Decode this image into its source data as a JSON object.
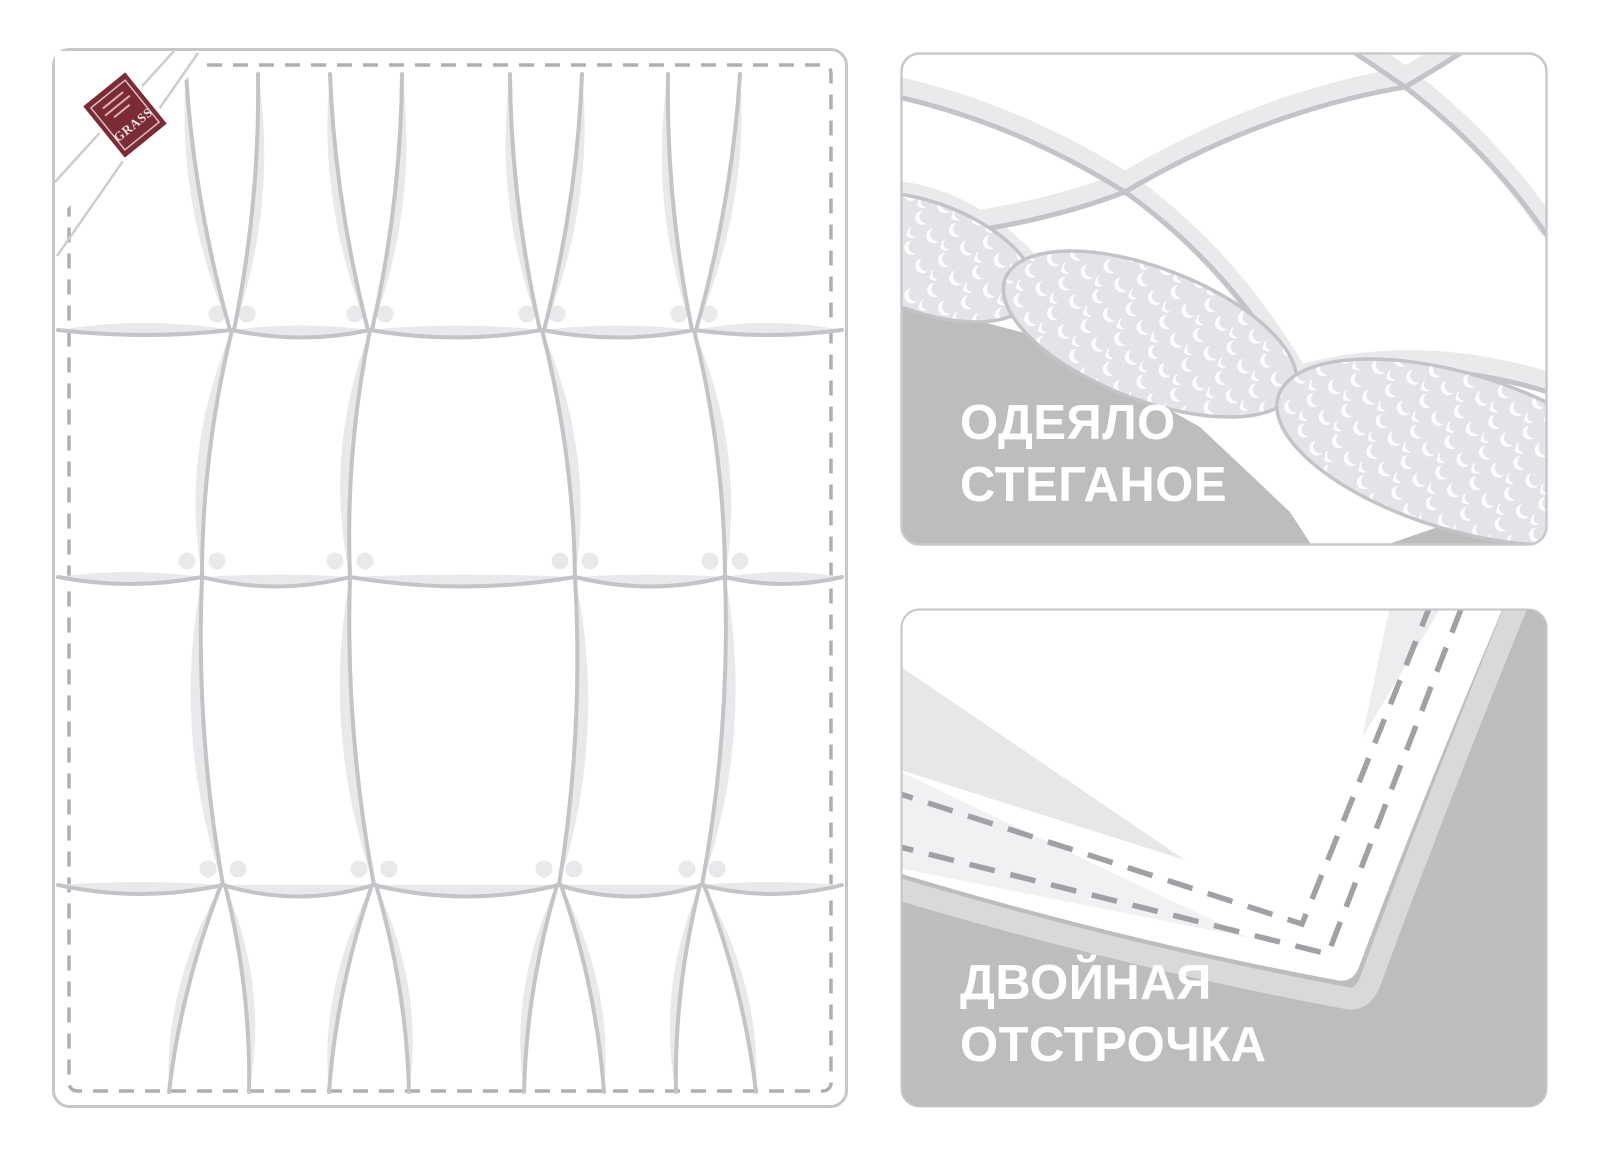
{
  "page": {
    "background": "#ffffff"
  },
  "colors": {
    "panel_gray": "#bdbdbd",
    "panel_border": "#c9c9cd",
    "blanket_outline": "#c7c7cb",
    "seam": "#c3c3c8",
    "shade": "#e9e9ec",
    "band": "#eaeaed",
    "border_dash": "#aeaeb3",
    "stitch_dash": "#a0a0a5",
    "texture_bg": "#e4e4e8",
    "thickness": "#d9d9db",
    "wedge_dark": "#e7e7ea",
    "wedge_light": "#f1f1f3",
    "fold_line": "#cdcdd1",
    "label_red": "#7b2b34",
    "label_text": "#eedfe1",
    "caption_text": "#ffffff"
  },
  "blanket": {
    "label_brand": "GRASS"
  },
  "panels": [
    {
      "id": "quilted",
      "line1": "ОДЕЯЛО",
      "line2": "СТЕГАНОЕ"
    },
    {
      "id": "stitching",
      "line1": "ДВОЙНАЯ",
      "line2": "ОТСТРОЧКА"
    }
  ]
}
